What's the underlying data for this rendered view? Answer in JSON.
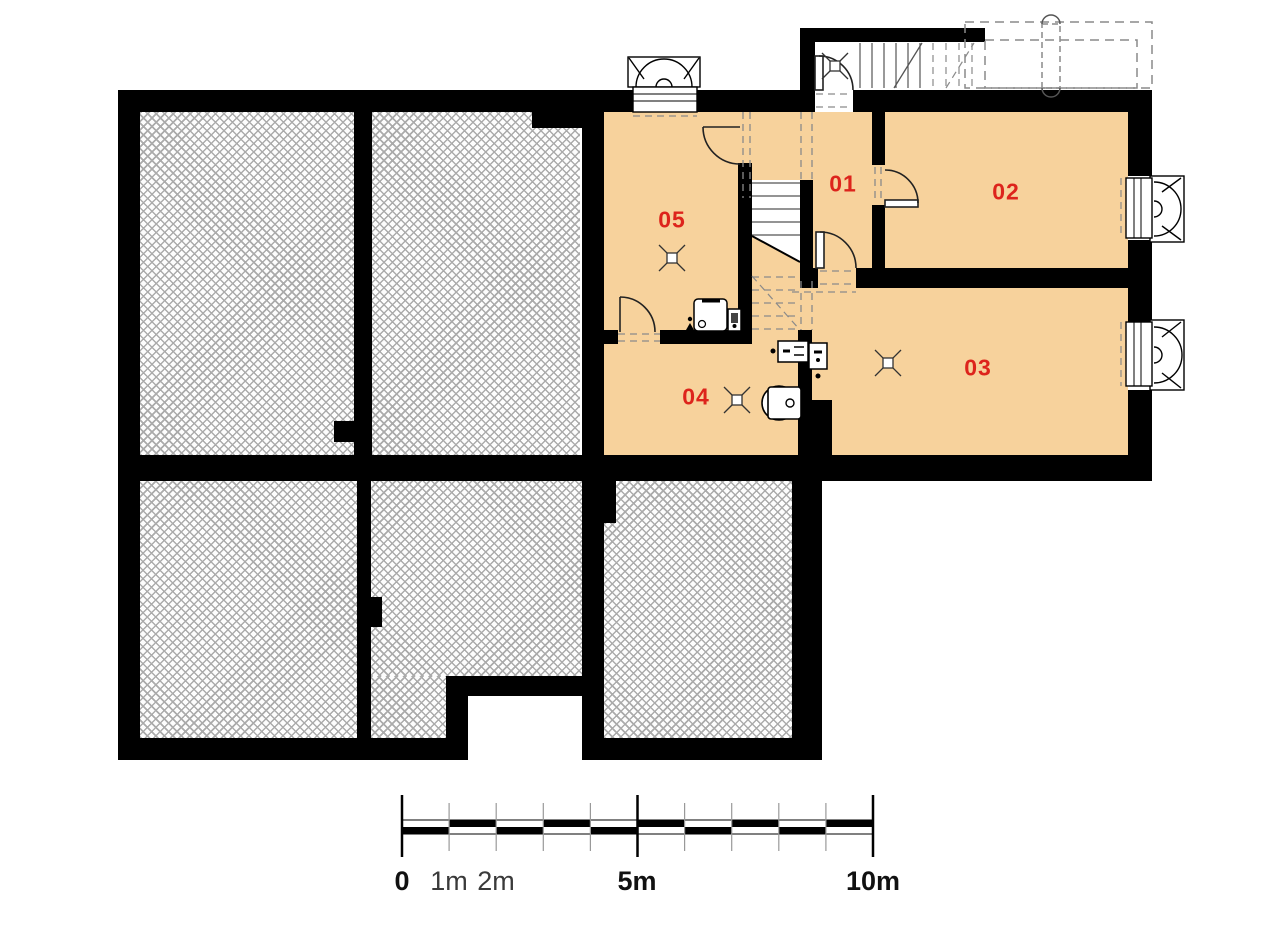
{
  "rooms": [
    {
      "id": "01"
    },
    {
      "id": "02"
    },
    {
      "id": "03"
    },
    {
      "id": "04"
    },
    {
      "id": "05"
    }
  ],
  "scale_bar": {
    "tick_labels": [
      "0",
      "1m",
      "2m",
      "5m",
      "10m"
    ],
    "unit": "m"
  },
  "colors": {
    "wall": "#000000",
    "floor_orange": "#f7d29c",
    "room_label_red": "#dd241c",
    "hatch_line_gray": "#ababab",
    "dash_gray": "#8a8a8a"
  },
  "symbols": [
    {
      "name": "window-well-icon"
    },
    {
      "name": "basement-window-icon"
    },
    {
      "name": "door-swing-icon"
    },
    {
      "name": "interior-staircase-icon"
    },
    {
      "name": "exterior-stairs-icon"
    },
    {
      "name": "terrace-dashed-outline-icon"
    },
    {
      "name": "column-icon"
    },
    {
      "name": "ceiling-light-icon"
    },
    {
      "name": "boiler-icon"
    },
    {
      "name": "washing-machine-icon"
    },
    {
      "name": "electrical-meter-icon"
    },
    {
      "name": "floor-drain-icon"
    },
    {
      "name": "unexcavated-hatch"
    }
  ]
}
